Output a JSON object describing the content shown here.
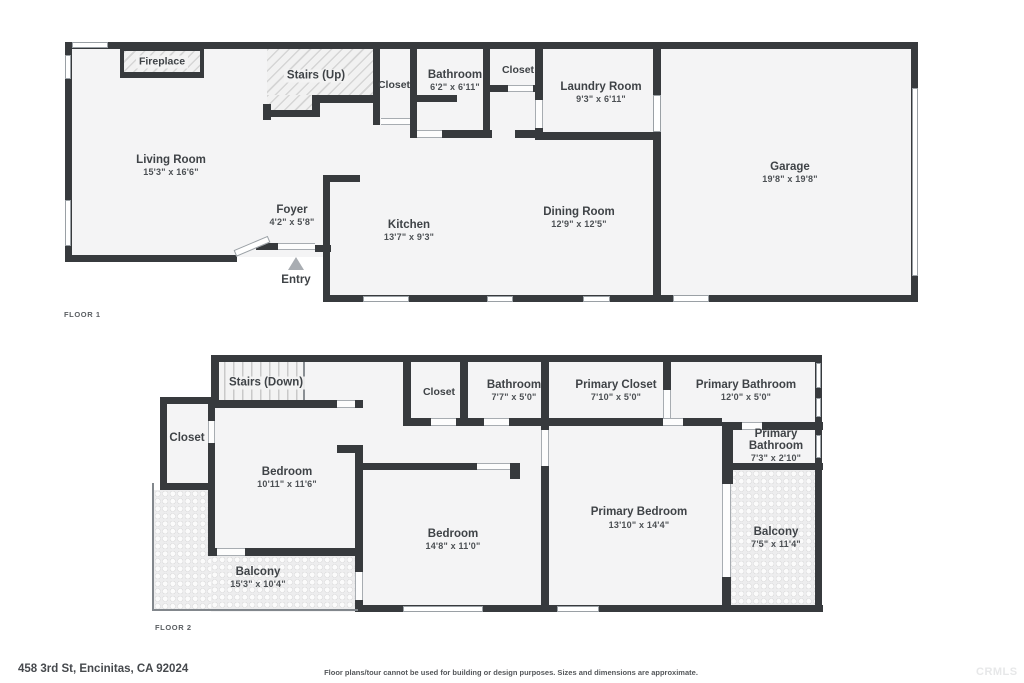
{
  "floor1": {
    "tag": "FLOOR 1",
    "rooms": {
      "living": {
        "name": "Living Room",
        "dims": "15'3\" x 16'6\""
      },
      "fireplace": {
        "name": "Fireplace"
      },
      "stairs": {
        "name": "Stairs (Up)"
      },
      "closet_hall": {
        "name": "Closet"
      },
      "bathroom": {
        "name": "Bathroom",
        "dims": "6'2\" x 6'11\""
      },
      "closet_laundry": {
        "name": "Closet"
      },
      "laundry": {
        "name": "Laundry Room",
        "dims": "9'3\" x 6'11\""
      },
      "garage": {
        "name": "Garage",
        "dims": "19'8\" x 19'8\""
      },
      "foyer": {
        "name": "Foyer",
        "dims": "4'2\" x 5'8\""
      },
      "kitchen": {
        "name": "Kitchen",
        "dims": "13'7\" x 9'3\""
      },
      "dining": {
        "name": "Dining Room",
        "dims": "12'9\" x 12'5\""
      },
      "entry": {
        "name": "Entry"
      }
    }
  },
  "floor2": {
    "tag": "FLOOR 2",
    "rooms": {
      "stairs": {
        "name": "Stairs (Down)"
      },
      "closet_left": {
        "name": "Closet"
      },
      "bedroom_left": {
        "name": "Bedroom",
        "dims": "10'11\" x 11'6\""
      },
      "closet_hall": {
        "name": "Closet"
      },
      "bathroom": {
        "name": "Bathroom",
        "dims": "7'7\" x 5'0\""
      },
      "primary_closet": {
        "name": "Primary Closet",
        "dims": "7'10\" x 5'0\""
      },
      "primary_bathroom": {
        "name": "Primary Bathroom",
        "dims": "12'0\" x 5'0\""
      },
      "primary_bathroom_small": {
        "line1": "Primary",
        "line2": "Bathroom",
        "dims": "7'3\" x 2'10\""
      },
      "bedroom_mid": {
        "name": "Bedroom",
        "dims": "14'8\" x 11'0\""
      },
      "primary_bedroom": {
        "name": "Primary Bedroom",
        "dims": "13'10\" x 14'4\""
      },
      "balcony_left": {
        "name": "Balcony",
        "dims": "15'3\" x 10'4\""
      },
      "balcony_right": {
        "name": "Balcony",
        "dims": "7'5\" x 11'4\""
      }
    }
  },
  "footer": {
    "address": "458 3rd St, Encinitas, CA 92024",
    "disclaimer": "Floor plans/tour cannot be used for building or design purposes. Sizes and dimensions are approximate.",
    "watermark": "CRMLS"
  },
  "colors": {
    "wall": "#373a3d",
    "room_fill": "#f4f4f5",
    "text": "#3f4347"
  }
}
